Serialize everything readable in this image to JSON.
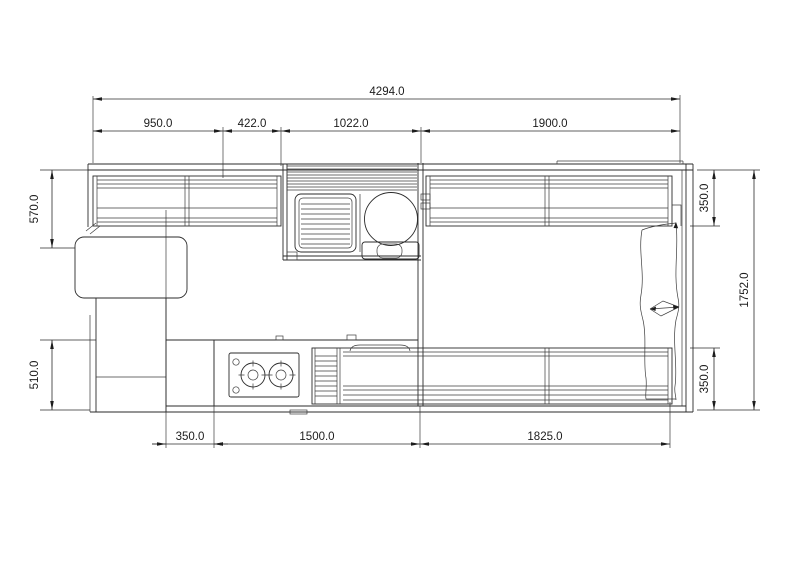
{
  "dims": {
    "total_length": "4294.0",
    "top_a": "950.0",
    "top_b": "422.0",
    "top_c": "1022.0",
    "top_d": "1900.0",
    "left_top": "570.0",
    "left_bottom": "510.0",
    "right_top": "350.0",
    "right_bottom": "350.0",
    "total_width": "1752.0",
    "bottom_a": "350.0",
    "bottom_b": "1500.0",
    "bottom_c": "1825.0"
  }
}
